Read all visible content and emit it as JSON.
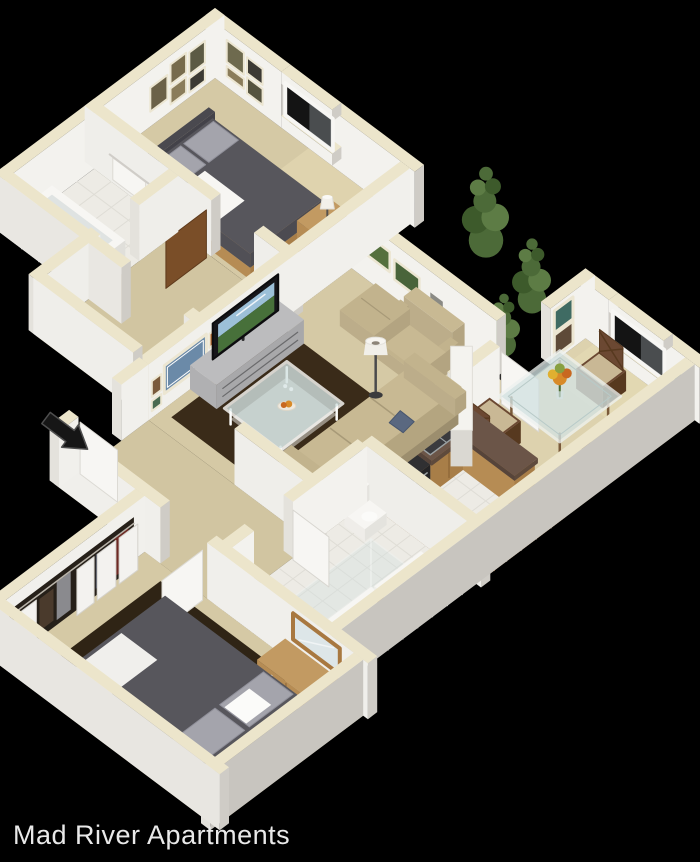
{
  "caption": "Mad River Apartments",
  "floorplan": {
    "view": "3d-isometric-dollhouse-floor-plan",
    "unit": "two bedroom apartment",
    "rooms": [
      {
        "name": "bedroom-1",
        "position": "top",
        "furniture": [
          "double bed with charcoal duvet",
          "gray pillows",
          "white throw",
          "wood nightstand",
          "table lamp",
          "wall art clusters"
        ],
        "features": [
          "window with dark pane"
        ]
      },
      {
        "name": "bathroom-1",
        "position": "upper-left",
        "furniture": [
          "bathtub",
          "towel on rack"
        ],
        "features": [
          "tile floor"
        ]
      },
      {
        "name": "hallway-1",
        "position": "center-left",
        "furniture": [],
        "features": [
          "open brown door to bedroom 1"
        ]
      },
      {
        "name": "living-room",
        "position": "center",
        "furniture": [
          "beige sofa with navy pillows",
          "armchair",
          "ottoman",
          "floor lamp",
          "glass coffee table with food",
          "tv with landscape on screen",
          "gray media console",
          "dark brown area rug",
          "gallery wall art"
        ],
        "features": []
      },
      {
        "name": "dining-area",
        "position": "right",
        "furniture": [
          "glass dining table",
          "three espresso chairs with tan seats",
          "flower centerpiece"
        ],
        "features": [
          "window",
          "framed art",
          "open white door"
        ]
      },
      {
        "name": "kitchen",
        "position": "center-right",
        "furniture": [
          "oak cabinets",
          "granite counter with double sink",
          "black range",
          "white breakfast bar"
        ],
        "features": [
          "white tile and wood floor"
        ]
      },
      {
        "name": "bathroom-2",
        "position": "lower-right",
        "furniture": [
          "glass shower",
          "toilet",
          "wood vanity"
        ],
        "features": [
          "white tile floor"
        ]
      },
      {
        "name": "bedroom-2",
        "position": "bottom",
        "furniture": [
          "large bed with charcoal duvet and gray pillows",
          "wood dresser",
          "wall mirror",
          "closet with white bifold doors and hanging clothes",
          "dark area rug"
        ],
        "features": []
      }
    ],
    "exterior": [
      "black entry arrow at left",
      "green trees behind upper-right walls",
      "black background"
    ]
  },
  "palette": {
    "background": "#000000",
    "caption_color": "#e9e9e9",
    "wallTop": "#ece5cb",
    "wallInner": "#f3f2ee",
    "wallInner2": "#efeeea",
    "wallOuterLight": "#e4e2dc",
    "wallOuterDark": "#cfccc6",
    "wallOuterEast": "#c8c5bf",
    "carpet": "#d5c9a5",
    "carpetDark": "#d1c5a1",
    "carpetLight": "#ddd2ae",
    "sun": "#ece0ba",
    "bathTile": "#edebe5",
    "tileLine": "#dfddd6",
    "kitchenWood": "#d89a5e",
    "kitchenWoodLine": "#c4874c",
    "rugLiving": "#3a2b19",
    "rugBedroom": "#2f2415",
    "bedDuvet": "#57565c",
    "bedDuvetSide": "#4c4b51",
    "bedDuvetSide2": "#515056",
    "pillowGray": "#a4a4ac",
    "pillowEdge": "#90909a",
    "headboard": "#4a494f",
    "woodTop": "#c29a62",
    "woodFace": "#b0824c",
    "woodFaceDark": "#a87e48",
    "woodSide": "#b68c54",
    "woodLine": "#8a6436",
    "espresso": "#6b4832",
    "espressoDark": "#57391f",
    "seatPad": "#c9b895",
    "sofaTop": "#c8b993",
    "sofaSide": "#b4a580",
    "sofaBase": "#a89a78",
    "sofaArm": "#c2b38d",
    "sofaArmDark": "#b3a481",
    "sofaLight": "#bcad8a",
    "seam": "#a89a78",
    "navyPillow": "#5a6880",
    "navyPillowDark": "#48566e",
    "granite": "#6b5548",
    "graniteSide": "#5e4a3c",
    "graniteDark": "#56443a",
    "steel": "#3a3a3e",
    "steelRim": "#9aa0a2",
    "glass": "#d3e2e2",
    "glassFrame": "#eef2f0",
    "glassLine": "#b8cac8",
    "tvFrame": "#16161a",
    "tvSky": "#9cc0d8",
    "tvLand": "#47703a",
    "consoleTop": "#bcbcbe",
    "consoleFace": "#a8a8aa",
    "consoleSide": "#b0b0b2",
    "consoleLine": "#6a6a6c",
    "tree": "#4c6a38",
    "treeDark": "#3d5a2b",
    "treeLight": "#5d7c45",
    "flowerOrange": "#d88a28",
    "flowerYellow": "#e0b030",
    "flowerRust": "#c86820",
    "flowerGreen": "#88a040",
    "stem": "#4a6a30",
    "doorBrown": "#7a4e28",
    "doorBrownEdge": "#5e3a1c",
    "white": "#f7f6f3",
    "whiteDim": "#ececea",
    "frameCream": "#ece6d2",
    "paneDark": "#141414",
    "blind": "#9aa2a8",
    "artSea": "#6b8aa8",
    "artGreen1": "#55703d",
    "artGreen2": "#49643a",
    "artTeal": "#3f6b63",
    "artRust": "#b86a30",
    "artOlive": "#6e6a4e",
    "artDark": "#3c3a34",
    "artTan": "#8a7c5a",
    "artBrown": "#5e4a38",
    "artKhaki": "#55533f",
    "artGray": "#8a8a84",
    "artMoss": "#4a6a50",
    "arrow": "#161616",
    "arrowEdge": "#4e4e4e",
    "mirrorGlass": "#dde6e8",
    "mirrorFrame": "#a87840"
  }
}
